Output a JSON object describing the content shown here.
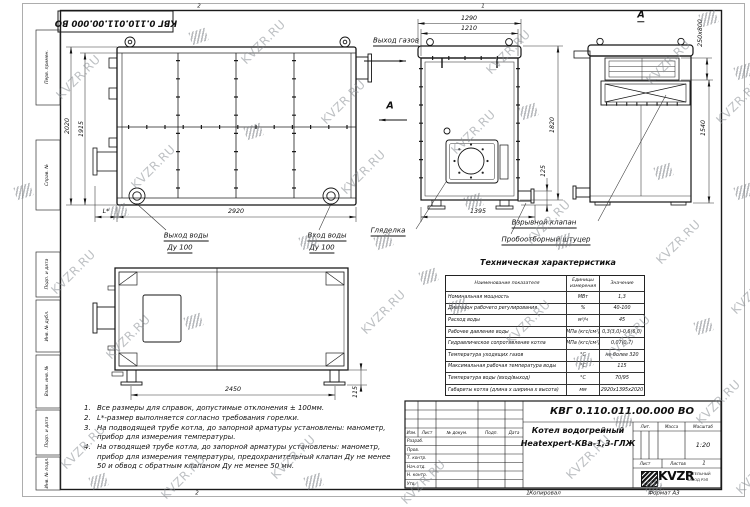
{
  "watermark": {
    "text": "KVZR.RU"
  },
  "frame": {
    "top_stamp": "КВГ 0.110.011.00.000 ВО",
    "side_labels": [
      "Перв. примен.",
      "Справ. №",
      "Подп. и дата",
      "Инв. № дубл.",
      "Взам. инв. №",
      "Подп. и дата",
      "Инв. № подл."
    ],
    "zones": {
      "top_2": "2",
      "top_1": "1",
      "bottom_2": "2",
      "bottom_1": "1"
    }
  },
  "views": {
    "section_letter": "А",
    "side": {
      "dim_width": "2920",
      "dim_height_outer": "2020",
      "dim_height_inner": "1915",
      "dim_burner": "L*",
      "label_gas_outlet": "Выход газов",
      "label_water_out_line1": "Выход воды",
      "label_water_out_line2": "Ду 100",
      "label_water_in_line1": "Вход воды",
      "label_water_in_line2": "Ду 100"
    },
    "front": {
      "dim_w1": "1290",
      "dim_w2": "1210",
      "dim_h": "1820",
      "dim_stub": "125",
      "dim_base": "1395",
      "label_sight_glass": "Гляделка",
      "label_sampling": "Пробоотборный штуцер"
    },
    "rear": {
      "dim_duct": "250x800",
      "dim_h": "1540",
      "label_explosion_valve": "Взрывной клапан"
    },
    "plan": {
      "dim_feet": "2450",
      "dim_foot": "115"
    }
  },
  "tech_table": {
    "title": "Техническая характеристика",
    "headers": {
      "name": "Наименование показателя",
      "unit": "Единицы измерения",
      "value": "Значение"
    },
    "rows": [
      {
        "name": "Номинальная мощность",
        "unit": "МВт",
        "value": "1,3"
      },
      {
        "name": "Диапазон рабочего регулирования",
        "unit": "%",
        "value": "40-100"
      },
      {
        "name": "Расход воды",
        "unit": "м³/ч",
        "value": "45"
      },
      {
        "name": "Рабочее давление воды",
        "unit": "МПа (кгс/см²)",
        "value": "0,3(3,0)-0,6(6,0)"
      },
      {
        "name": "Гидравлическое сопротивление котла",
        "unit": "МПа (кгс/см²)",
        "value": "0,07(0,7)"
      },
      {
        "name": "Температура уходящих газов",
        "unit": "°С",
        "value": "не более 320"
      },
      {
        "name": "Максимальная рабочая температура воды",
        "unit": "°С",
        "value": "115"
      },
      {
        "name": "Температура воды (вход/выход)",
        "unit": "°С",
        "value": "70/95"
      },
      {
        "name": "Габариты котла (длина х ширина х высота)",
        "unit": "мм",
        "value": "2920х1395х2020"
      }
    ]
  },
  "notes": {
    "items": [
      {
        "num": "1.",
        "text": "Все размеры для справок, допустимые отклонения ± 100мм."
      },
      {
        "num": "2.",
        "text": "L*-размер выполняется согласно требования горелки."
      },
      {
        "num": "3.",
        "text": "На подводящей трубе котла, до запорной арматуры установлены: манометр, прибор для измерения температуры."
      },
      {
        "num": "4.",
        "text": "На отводящей трубе котла, до запорной арматуры установлены: манометр, прибор для измерения температуры, предохранительный клапан Ду не менее 50 и обвод с обратным клапаном Ду не менее 50 мм."
      }
    ]
  },
  "title_block": {
    "doc_number": "КВГ 0.110.011.00.000 ВО",
    "product_line1": "Котел водогрейный",
    "product_line2": "Heatexpert-КВа-1,3-ГЛЖ",
    "col_headers": [
      "Изм.",
      "Лист",
      "№ докум.",
      "Подп.",
      "Дата"
    ],
    "row_labels": [
      "Разраб.",
      "Пров.",
      "Т. контр.",
      "Нач.отд.",
      "Н. контр.",
      "Утв."
    ],
    "lit_label": "Лит.",
    "mass_label": "Масса",
    "scale_label": "Масштаб",
    "scale_value": "1:20",
    "sheet_label": "Лист",
    "sheets_label": "Листов",
    "sheets_value": "1",
    "logo_text": "KVZR",
    "logo_sub1": "КОТЕЛЬНЫЙ",
    "logo_sub2": "ЗАВОД РЭП",
    "copied_label": "Копировал",
    "format_label": "Формат А3"
  }
}
